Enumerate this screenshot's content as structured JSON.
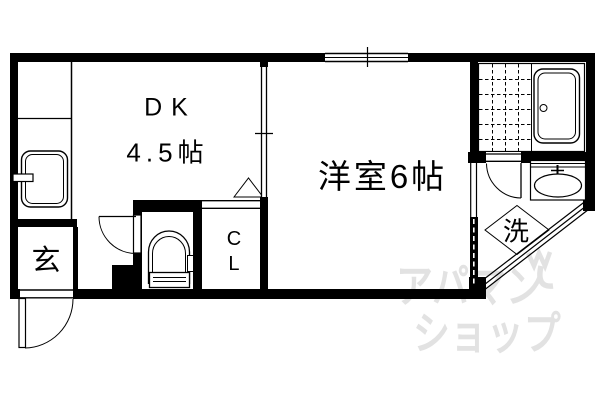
{
  "floorplan": {
    "rooms": {
      "dining_kitchen": {
        "name": "DK",
        "area": "4.5帖"
      },
      "western_room": {
        "name": "洋室6帖"
      },
      "entrance": {
        "name": "玄"
      },
      "closet": {
        "abbr_line1": "C",
        "abbr_line2": "L"
      },
      "laundry": {
        "name": "洗"
      }
    },
    "watermark": {
      "line1": "アパマン",
      "line2": "ショップ",
      "color": "#e2e2e2"
    },
    "colors": {
      "wall": "#000000",
      "background": "#ffffff",
      "line": "#000000"
    }
  }
}
